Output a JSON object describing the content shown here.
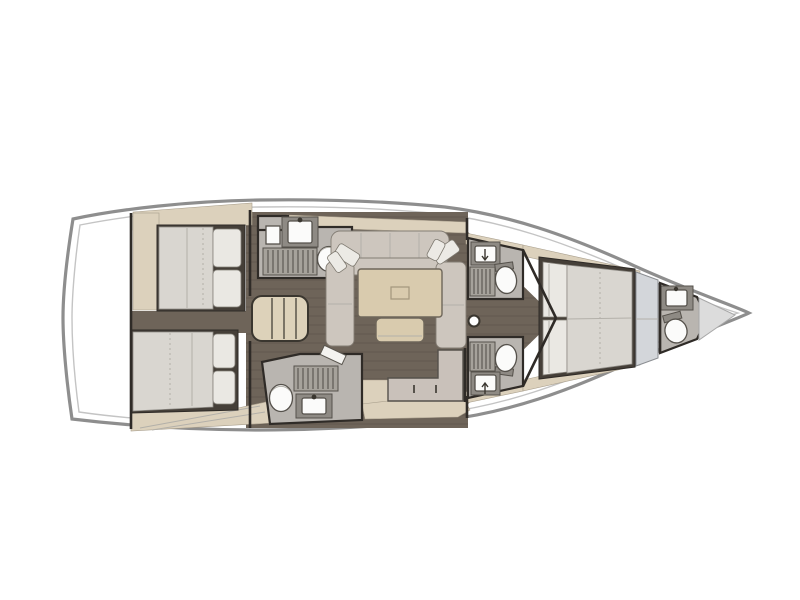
{
  "figure": {
    "kind": "sailing-yacht-interior-deck-plan",
    "view": "top-down",
    "orientation": "bow-right",
    "rooms": [
      {
        "id": "stern-platform",
        "name": "stern deck"
      },
      {
        "id": "aft-cabin-port",
        "name": "aft double cabin port",
        "fixtures": [
          "double-berth",
          "pillows",
          "cabinetry"
        ]
      },
      {
        "id": "aft-cabin-starboard",
        "name": "aft double cabin starboard",
        "fixtures": [
          "double-berth",
          "pillows",
          "cabinetry"
        ]
      },
      {
        "id": "companionway",
        "name": "companionway steps"
      },
      {
        "id": "head-aft-port",
        "name": "aft head port",
        "fixtures": [
          "sink",
          "shower-grate",
          "toilet",
          "door"
        ]
      },
      {
        "id": "head-aft-starboard",
        "name": "aft head starboard",
        "fixtures": [
          "toilet",
          "shower-grate",
          "sink",
          "door"
        ]
      },
      {
        "id": "saloon",
        "name": "saloon",
        "fixtures": [
          "u-shaped-sofa",
          "throw-pillows",
          "dining-table",
          "ottoman",
          "mast-post"
        ]
      },
      {
        "id": "galley",
        "name": "galley",
        "fixtures": [
          "l-shaped-counter",
          "drawer-handles"
        ]
      },
      {
        "id": "head-mid-port",
        "name": "forward head port",
        "fixtures": [
          "sink",
          "shower-grate",
          "toilet"
        ]
      },
      {
        "id": "head-mid-starboard",
        "name": "forward head starboard",
        "fixtures": [
          "shower-grate",
          "toilet",
          "sink"
        ]
      },
      {
        "id": "forward-cabin",
        "name": "forward owner cabin",
        "fixtures": [
          "island-double-berth",
          "pillows",
          "wardrobe-panel"
        ]
      },
      {
        "id": "head-bow",
        "name": "bow head",
        "fixtures": [
          "sink",
          "toilet"
        ]
      },
      {
        "id": "bow-locker",
        "name": "anchor locker"
      }
    ]
  },
  "palette": {
    "background": "#ffffff",
    "hull_outline": "#8e8e8e",
    "deck_line": "#c4c4c4",
    "wall": "#2f2b27",
    "floor_wood": "#6e6459",
    "cabinetry_beige": "#dcd1bc",
    "mattress": "#d9d6d0",
    "pillow": "#eae8e3",
    "sofa_cushion": "#cdc6be",
    "table_tan": "#d9cbae",
    "head_floor": "#b9b5b0",
    "worktop": "#c9c1ba",
    "fixture_white": "#fbfbfa",
    "wardrobe_gray": "#d3d6da"
  }
}
